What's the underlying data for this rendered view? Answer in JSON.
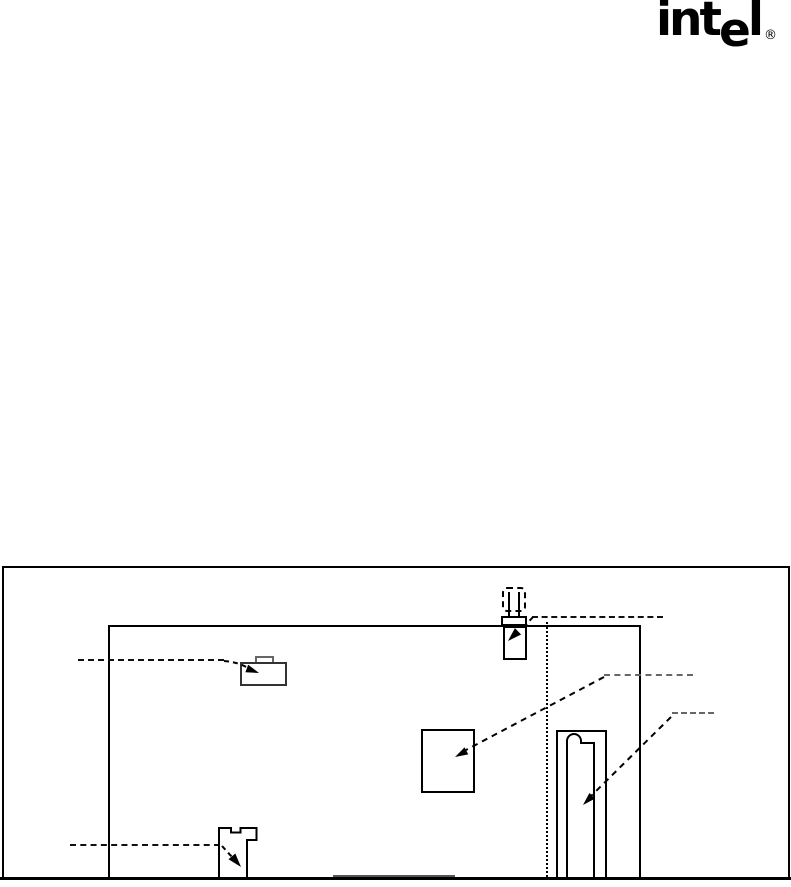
{
  "page": {
    "background": "#ffffff",
    "ink_color": "#000000",
    "leader_gray_color": "#666666"
  },
  "brand": {
    "logo_text": "intel",
    "logo_prefix": "int",
    "logo_e": "e",
    "logo_l": "l",
    "registered_mark": "®"
  },
  "figure": {
    "kind": "board component-location diagram (cropped at page bottom)",
    "components": [
      "figure-frame",
      "board-outline",
      "ghost-connector-dashed",
      "connector-with-pins",
      "small-chip-with-tab",
      "middle-chip",
      "keyed-slot",
      "notched-connector",
      "bottom-socket",
      "dotted-reference-line"
    ],
    "leader_lines": 5,
    "arrowheads": 5
  }
}
